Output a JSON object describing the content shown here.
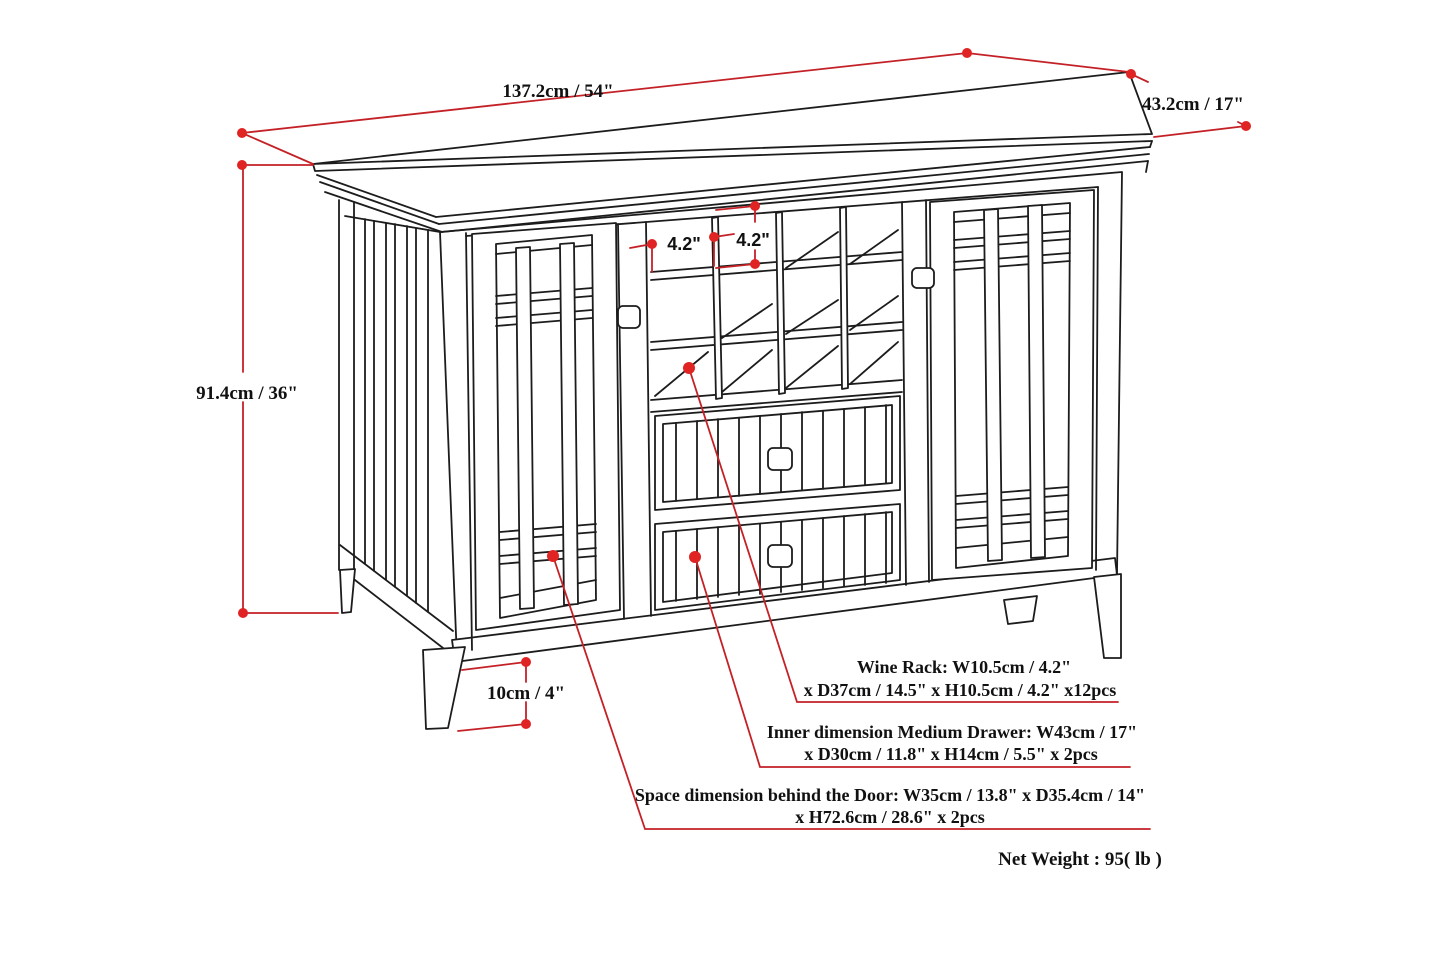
{
  "diagram": {
    "title": "sideboard-dimension-diagram",
    "dimensions": {
      "width": "137.2cm / 54\"",
      "depth": "43.2cm / 17\"",
      "height": "91.4cm / 36\"",
      "cubby_width": "4.2\"",
      "cubby_height": "4.2\"",
      "leg_height": "10cm / 4\""
    },
    "notes": {
      "wine_rack_line1": "Wine Rack: W10.5cm / 4.2\"",
      "wine_rack_line2": "x D37cm / 14.5\" x H10.5cm / 4.2\" x12pcs",
      "drawer_line1": "Inner dimension Medium Drawer: W43cm / 17\"",
      "drawer_line2": "x D30cm / 11.8\" x H14cm / 5.5\" x 2pcs",
      "door_line1": "Space dimension behind the Door:  W35cm / 13.8\" x D35.4cm / 14\"",
      "door_line2": "x H72.6cm / 28.6\" x 2pcs",
      "net_weight": "Net Weight : 95( lb )"
    },
    "colors": {
      "dimension_line_red": "#c42127",
      "dimension_dot_red": "#e02424",
      "line_black": "#1c1c1c",
      "background": "#ffffff"
    }
  }
}
